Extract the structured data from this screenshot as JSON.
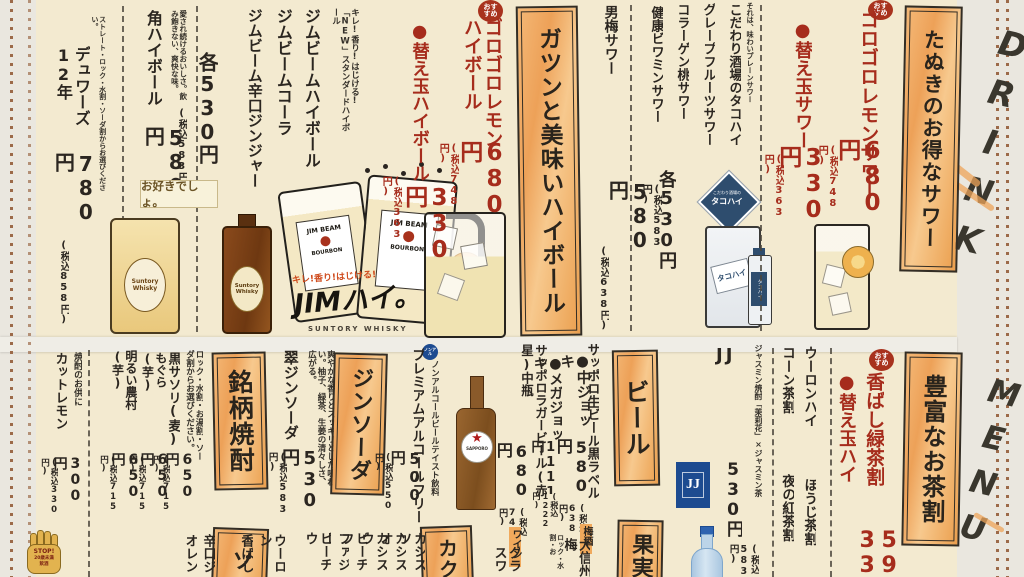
{
  "paper": {
    "drink": "DRINK",
    "menu": "MENU"
  },
  "badges": {
    "osusume": "おすすめ",
    "nonal": "ノンアル"
  },
  "stop_mark": {
    "line1": "STOP!",
    "line2": "20歳未満",
    "line3": "飲酒"
  },
  "top": {
    "tanuki": {
      "header": "たぬきのお得なサワー",
      "item1": {
        "name": "ゴロゴロレモンサワー",
        "price": "680円",
        "tax": "(税込748円)"
      },
      "item2": {
        "name": "●替え玉サワー",
        "price": "330円",
        "tax": "(税込363円)"
      }
    },
    "takohai": {
      "tagline": "それは、味わいプレーンサワー",
      "list": [
        "こだわり酒場のタコハイ",
        "グレープフルーツサワー",
        "コラーゲン桃サワー",
        "健康ビワミンサワー"
      ],
      "group_price": "各530円",
      "group_tax": "(税込583円)",
      "umeboshi": {
        "name": "男梅サワー",
        "price": "580円",
        "tax": "(税込638円)"
      },
      "badge_small": "こだわり酒場の",
      "badge_big": "タコハイ"
    },
    "highball": {
      "header": "ガツンと美味いハイボール",
      "item1": {
        "name": "ゴロゴロレモンハイボール",
        "price": "680円",
        "tax": "(税込748円)"
      },
      "item2": {
        "name": "●替え玉ハイボール",
        "price": "330円",
        "tax": "(税込363円)"
      }
    },
    "jim": {
      "note": "キレ!香り!はじける!「NEW」スタンダードハイボール",
      "list": [
        "ジムビームハイボール",
        "ジムビームコーラ",
        "ジムビーム辛口ジンジャー"
      ],
      "group_price": "各530円",
      "group_tax": "(税込583円)"
    },
    "kaku": {
      "note": "愛され続けるおいしさ。飲み飽きない、爽快な味。",
      "name": "角ハイボール",
      "price": "580円",
      "tax": "(税込638円)"
    },
    "dewars": {
      "note": "ストレート・ロック・水割・ソーダ割からお選びください。",
      "name": "デュワーズ12年",
      "price": "780円",
      "tax": "(税込858円)"
    },
    "art": {
      "osuki": "お好きでしょ。",
      "suntory": "Suntory Whisky",
      "jimbeam": "JIM BEAM",
      "bourbon": "BOURBON",
      "kire": "キレ!香り!はじける!",
      "jimhai": "JIMハイ。",
      "caption": "SUNTORY WHISKY"
    }
  },
  "bottom": {
    "ocha": {
      "header": "豊富なお茶割",
      "f1": {
        "name": "香ばし緑茶割",
        "price": "590"
      },
      "f2": {
        "name": "●替え玉ハイ",
        "price": "330"
      },
      "list": [
        "ウーロンハイ",
        "コーン茶割",
        "ほうじ茶割",
        "夜の紅茶割"
      ]
    },
    "jj": {
      "title": "JJ",
      "desc": "ジャスミン焼酎「茉莉花」×ジャスミン茶",
      "price": "530円",
      "tax": "(税込583円)",
      "logo": "JJ"
    },
    "beer": {
      "header": "ビール",
      "draft": "サッポロ生ビール黒ラベル",
      "opt1": {
        "name": "●中ジョッキ",
        "price": "580円",
        "tax": "(税込638円)"
      },
      "opt2": {
        "name": "●メガジョッキ",
        "price": "1111円",
        "tax": "(税込1222円)"
      },
      "lager": {
        "name": "サッポロラガービール(赤星)中瓶",
        "price": "680円",
        "tax": "(税込748円)"
      },
      "free_note": "ノンアルコールビールテイスト飲料",
      "free": {
        "name": "プレミアムアルコールフリー",
        "price": "500円",
        "tax": "(税込550円)"
      },
      "sapporo": "SAPPORO",
      "star": "★"
    },
    "wine": {
      "label": "ワイン",
      "item": "グラスワ"
    },
    "ume": {
      "label": "梅酒",
      "item": "大信州梅",
      "note": "ロック・水割・お"
    },
    "kajitsu_header": "果実",
    "gin": {
      "header": "ジンソーダ",
      "note": "爽やかな香りとスッキリとした味わい。柚子、緑茶、生姜の清々しさ、広がる。",
      "name": "翠ジンソーダ",
      "price": "530円",
      "tax": "(税込583円)"
    },
    "cocktail": {
      "header": "カク",
      "items": [
        "カシスソ",
        "カシスオ",
        "カシスウ",
        "ピーチフ",
        "ファジー",
        "ピーチウ"
      ]
    },
    "shochu": {
      "header": "銘柄焼酎",
      "note": "ロック・水割・お湯割・ソーダ割からお選びください。",
      "items": [
        {
          "name": "黒サソリ(麦)",
          "price": "650円",
          "tax": "(税込715円)"
        },
        {
          "name": "もぐら(芋)",
          "price": "650円",
          "tax": "(税込715円)"
        },
        {
          "name": "明るい農村(芋)",
          "price": "650円",
          "tax": "(税込715円)"
        }
      ]
    },
    "soft": {
      "header": "ソ",
      "items": [
        "ウーロン",
        "香ばし",
        "コカ・コ",
        "辛口ジ",
        "オレン"
      ]
    },
    "lemon": {
      "note": "焼酎のお供に",
      "name": "カットレモン",
      "price": "300円",
      "tax": "(税込330円)"
    }
  },
  "colors": {
    "accent_orange": "#efa75d",
    "price_red": "#a62c1c",
    "ink": "#2b2620",
    "paper": "#f3ead0",
    "jj_blue": "#1d4b90"
  }
}
